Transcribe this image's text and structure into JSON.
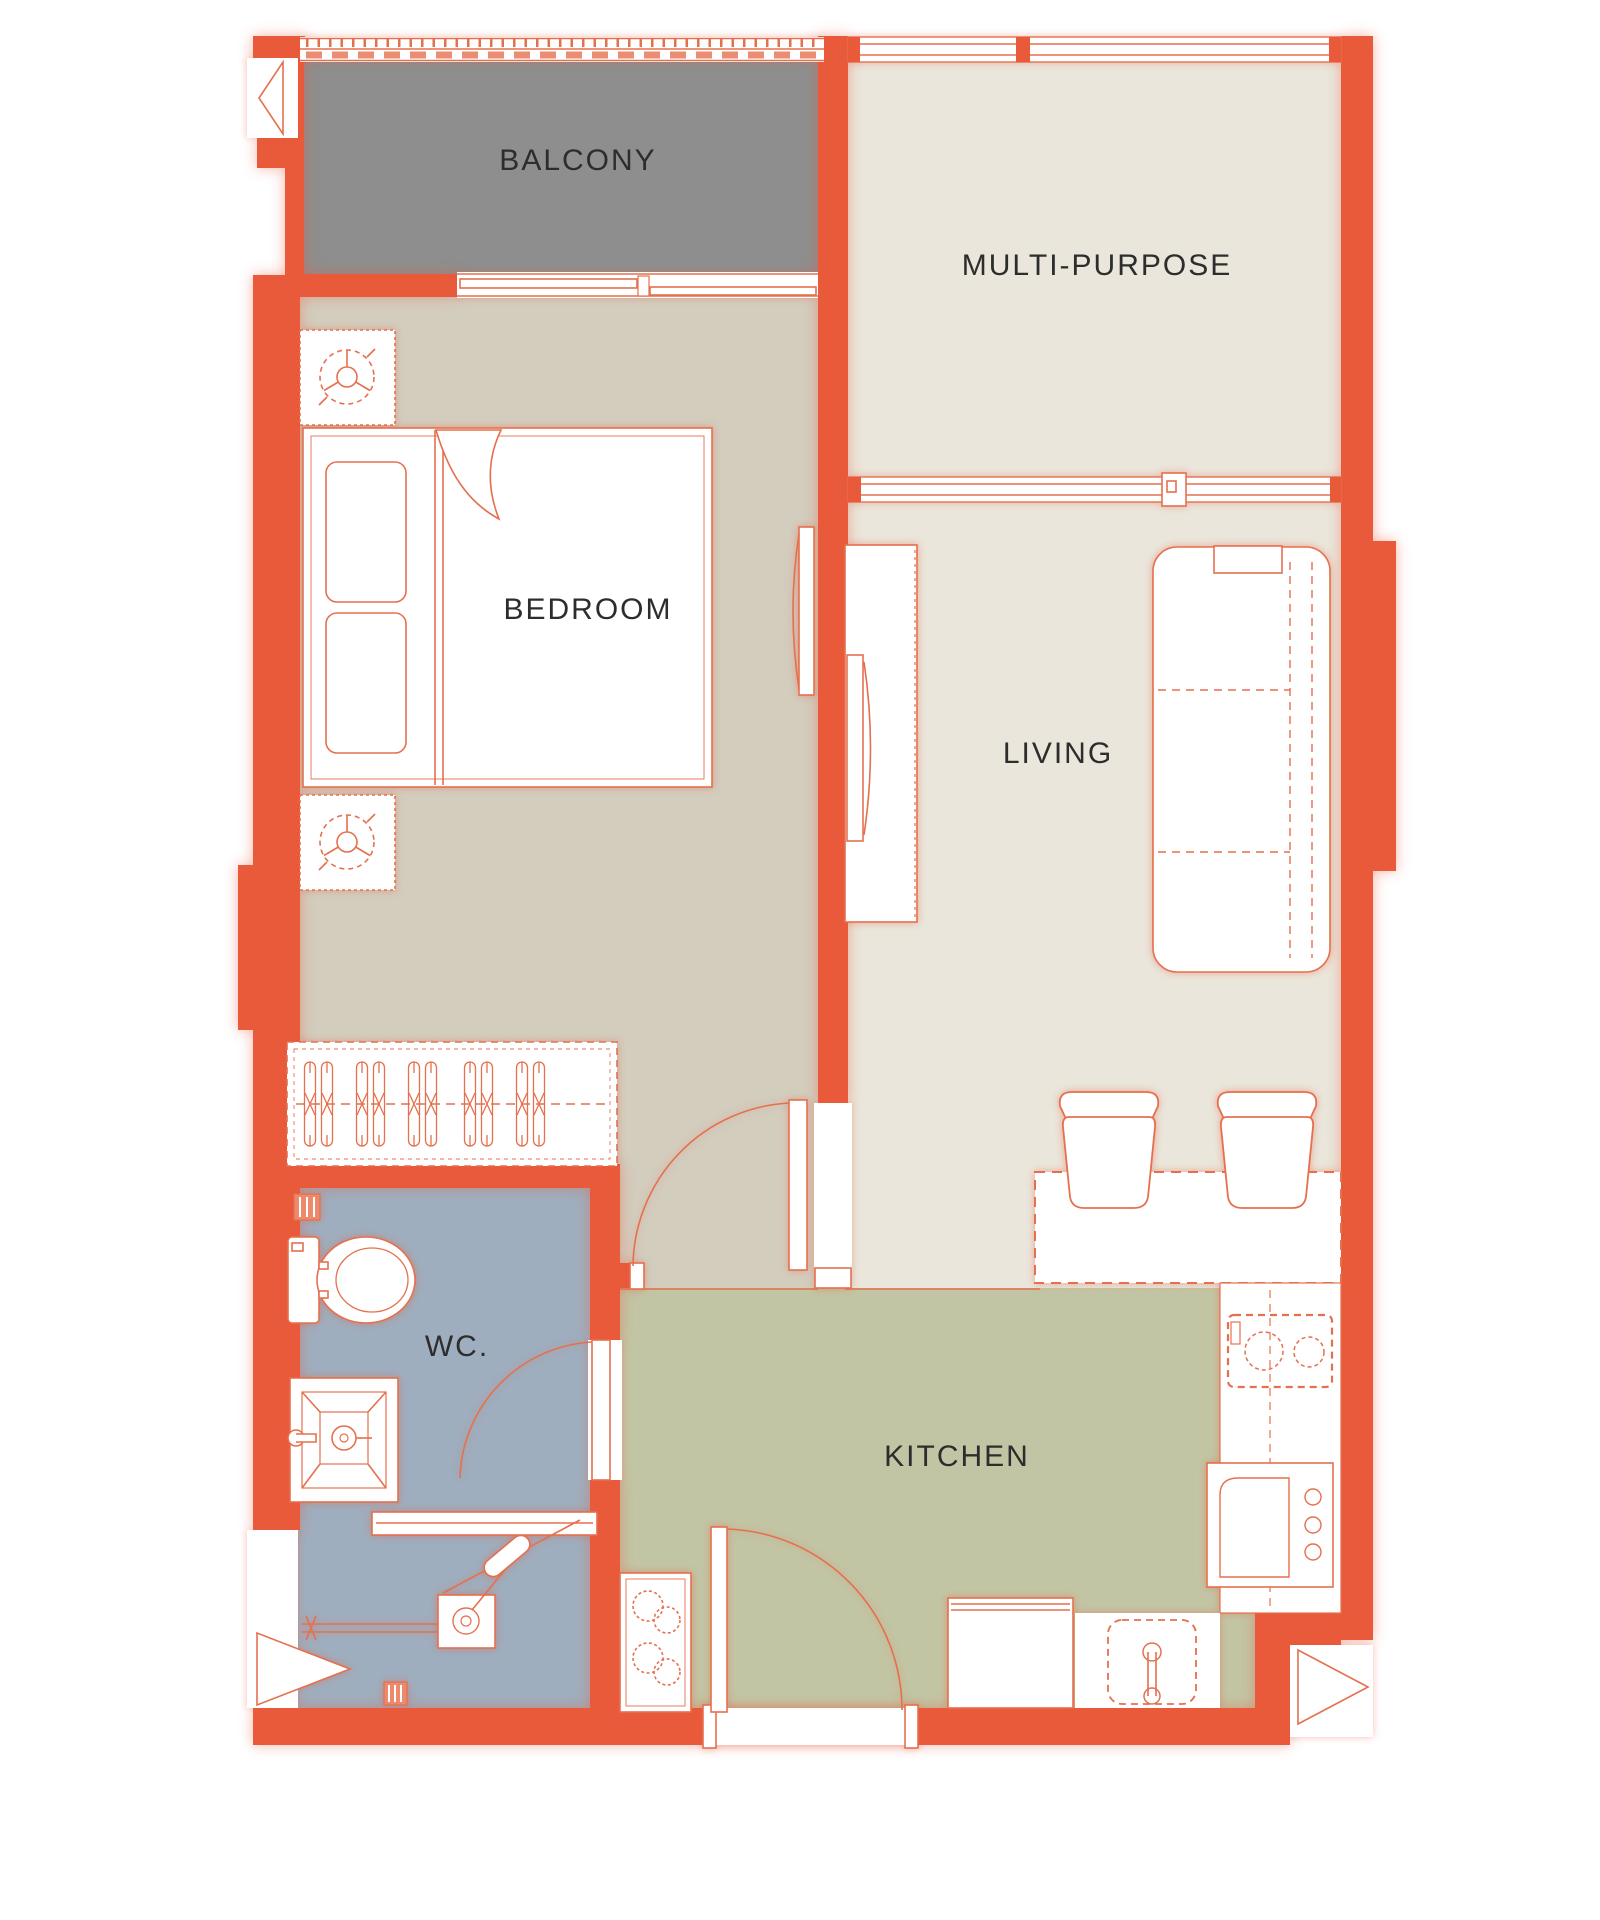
{
  "plan": {
    "rooms": [
      {
        "id": "balcony",
        "label": "BALCONY",
        "label_x": 578,
        "label_y": 161,
        "floor_color": "#8E8E8E"
      },
      {
        "id": "multi_purpose",
        "label": "MULTI-PURPOSE",
        "label_x": 1097,
        "label_y": 266,
        "floor_color": "#EAE6DB"
      },
      {
        "id": "bedroom",
        "label": "BEDROOM",
        "label_x": 588,
        "label_y": 610,
        "floor_color": "#D3CDBE"
      },
      {
        "id": "living",
        "label": "LIVING",
        "label_x": 1058,
        "label_y": 754,
        "floor_color": "#EAE6DB"
      },
      {
        "id": "wc",
        "label": "WC.",
        "label_x": 457,
        "label_y": 1347,
        "floor_color": "#9FAEBE"
      },
      {
        "id": "kitchen",
        "label": "KITCHEN",
        "label_x": 957,
        "label_y": 1457,
        "floor_color": "#C2C5A4"
      }
    ],
    "colors": {
      "wall": "#E95A3B",
      "line": "#E5704E",
      "background": "#FFFFFF",
      "label_text": "#2D2D2D"
    },
    "fixtures": [
      "balcony-railing",
      "window",
      "sliding-door",
      "double-bed",
      "pillows",
      "blanket",
      "nightstand-lamp",
      "wardrobe-with-hangers",
      "wall-tv",
      "tv-cabinet",
      "sofa",
      "counter-table",
      "stools",
      "toilet",
      "washbasin",
      "shower",
      "shower-screen",
      "floor-drain",
      "vent-grate",
      "kitchen-counter",
      "two-burner-stove",
      "microwave-oven",
      "refrigerator",
      "kitchen-sink",
      "tall-cabinet",
      "entrance-door",
      "bedroom-door",
      "wc-door",
      "window-direction-markers"
    ]
  }
}
